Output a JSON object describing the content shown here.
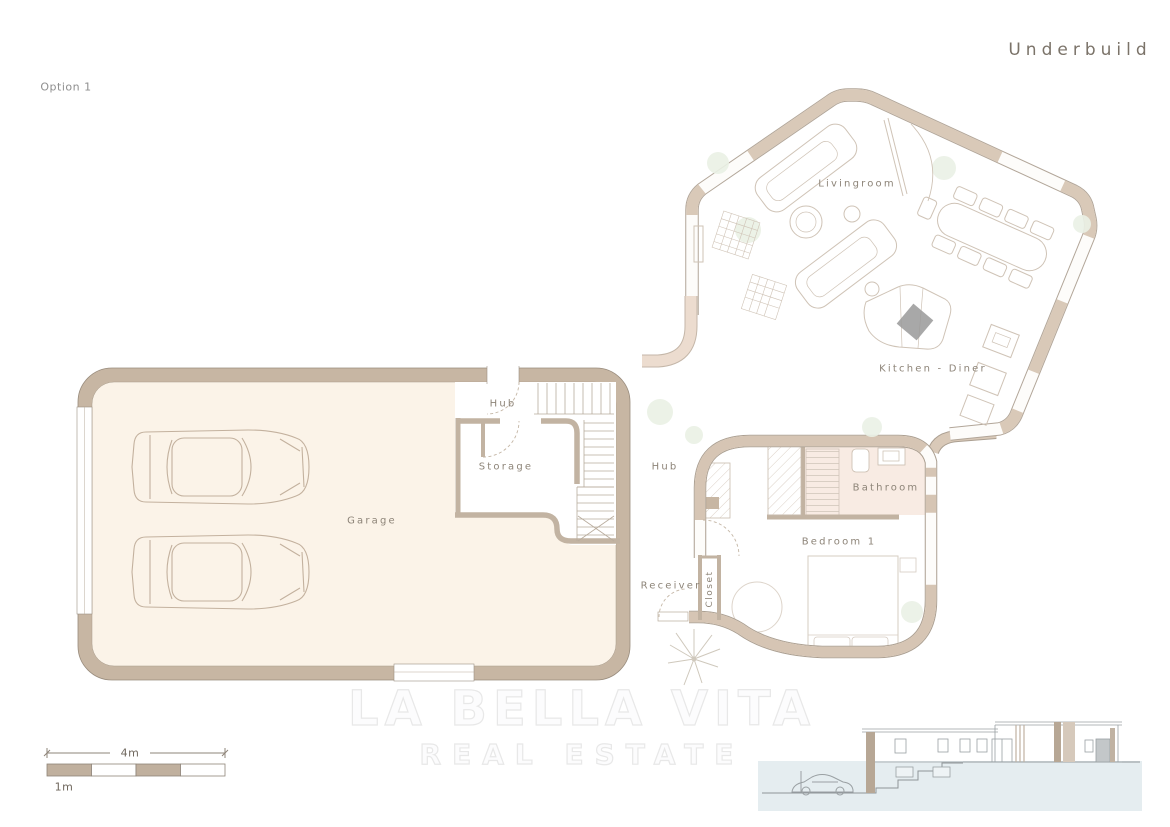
{
  "header": {
    "title": "Underbuild",
    "option": "Option 1"
  },
  "rooms": {
    "garage": "Garage",
    "hub_garage": "Hub",
    "storage": "Storage",
    "hub_main": "Hub",
    "livingroom": "Livingroom",
    "kitchen_diner": "Kitchen - Diner",
    "bathroom": "Bathroom",
    "bedroom1": "Bedroom 1",
    "receiver": "Receiver",
    "closet": "Closet"
  },
  "scale_bar": {
    "total": "4m",
    "unit": "1m"
  },
  "watermark": {
    "line1": "LA BELLA VITA",
    "line2": "REAL ESTATE"
  },
  "colors": {
    "wall_tan": "#c7b6a3",
    "wall_soft": "#d9c9b8",
    "wall_pink_tan": "#ecdccf",
    "floor_cream": "#fbf3e8",
    "bathroom_pink": "#f8ebe3",
    "label_gray": "#8d8478",
    "plant_green": "#eaf1e5",
    "elevation_blue": "#e5edf0",
    "cooktop_gray": "#999999"
  }
}
